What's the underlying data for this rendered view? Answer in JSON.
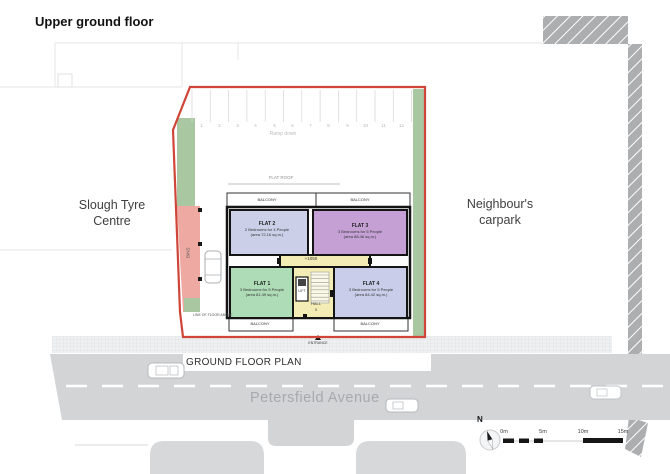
{
  "title": "Upper ground floor",
  "surroundings": {
    "left_building": "Slough Tyre Centre",
    "right_area": "Neighbour's carpark",
    "street": "Petersfield Avenue",
    "caption": "GROUND FLOOR PLAN"
  },
  "carpark": {
    "bays": [
      "1",
      "2",
      "3",
      "4",
      "5",
      "6",
      "7",
      "8",
      "9",
      "10",
      "11",
      "12"
    ],
    "ramp": "Ramp down",
    "flat_roof": "FLAT ROOF"
  },
  "site": {
    "bins": "BINS",
    "line_of_floor_above": "LINE OF FLOOR ABOVE",
    "level": "+1050",
    "lift": "LIFT",
    "hall": "HALL",
    "hall_level": "0",
    "entrance": "ENTRANCE",
    "balcony": "BALCONY",
    "flats": [
      {
        "name": "FLAT 1",
        "occupancy": "3 Bedrooms for 5 People",
        "area": "(area 81.49 sq.m.)"
      },
      {
        "name": "FLAT 2",
        "occupancy": "2 Bedrooms for 4 People",
        "area": "(area 72.16 sq.m.)"
      },
      {
        "name": "FLAT 3",
        "occupancy": "3 Bedrooms for 5 People",
        "area": "(area 88.46 sq.m.)"
      },
      {
        "name": "FLAT 4",
        "occupancy": "3 Bedrooms for 5 People",
        "area": "(area 84.42 sq.m.)"
      }
    ]
  },
  "legend": {
    "north": "N",
    "scale": [
      "0m",
      "5m",
      "10m",
      "15m"
    ]
  },
  "colors": {
    "boundary_red": "#cf4538",
    "flat1_green": "#aedcb6",
    "flat2_lavender": "#cbd0e8",
    "flat3_purple": "#c5a0d4",
    "flat4_lavender": "#c9cde9",
    "core_yellow": "#f3edb5",
    "landscape_green": "#a9c7a1",
    "bins_pink": "#eda9a2",
    "road_grey": "#d2d4d6"
  }
}
